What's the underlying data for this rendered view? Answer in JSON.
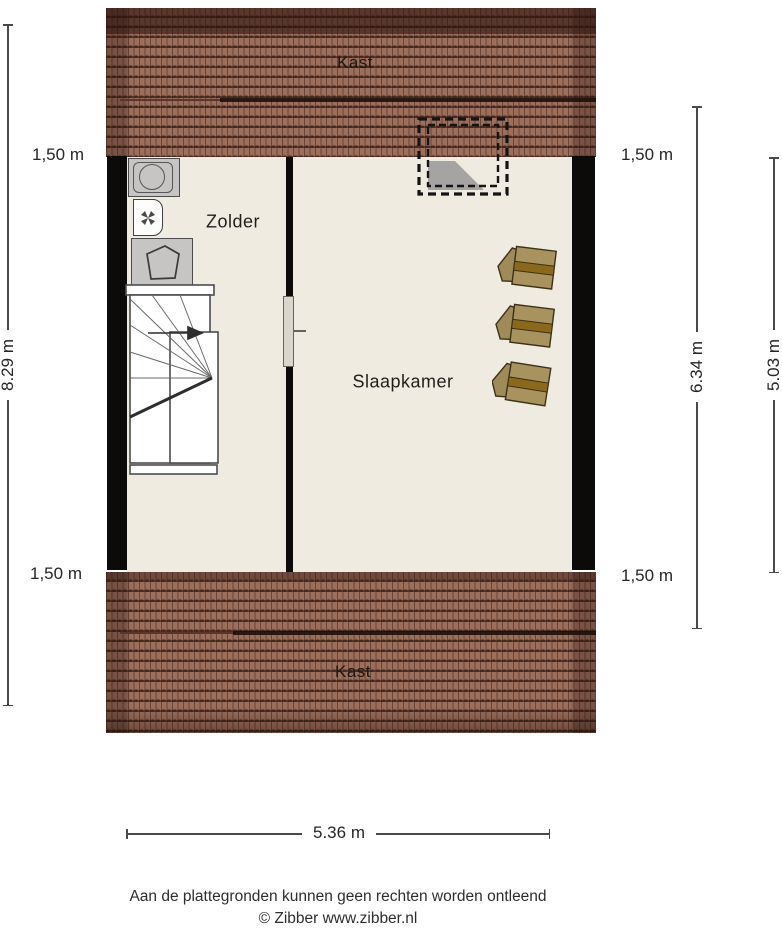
{
  "plan": {
    "labels": {
      "kast_top": "Kast",
      "zolder": "Zolder",
      "slaapkamer": "Slaapkamer",
      "kast_bottom": "Kast"
    },
    "dimensions": {
      "left_total": "8.29 m",
      "left_top": "1,50 m",
      "left_bottom": "1,50 m",
      "right_inner": "6.34 m",
      "right_outer": "5.03 m",
      "right_top": "1,50 m",
      "right_bottom": "1,50 m",
      "bottom_width": "5.36 m"
    },
    "footer": {
      "disclaimer": "Aan de plattegronden kunnen geen rechten worden ontleend",
      "credit": "© Zibber www.zibber.nl"
    },
    "icons": {
      "washing_machine": "washing-machine-icon",
      "ventilation_unit": "ventilation-unit-icon",
      "boiler": "boiler-icon",
      "skylight": "skylight-dashed-icon",
      "stairs": "winder-stairs-icon",
      "chairs": "roof-window-chair-icon"
    },
    "colors": {
      "floor": "#f0ebe1",
      "wall": "#0d0b09",
      "roof_base": "#9c6e5c",
      "roof_ridge": "#56342a",
      "chair_body": "#a8935f",
      "chair_stripe": "#8a691c",
      "skylight_shadow": "#9c9c9c"
    }
  }
}
